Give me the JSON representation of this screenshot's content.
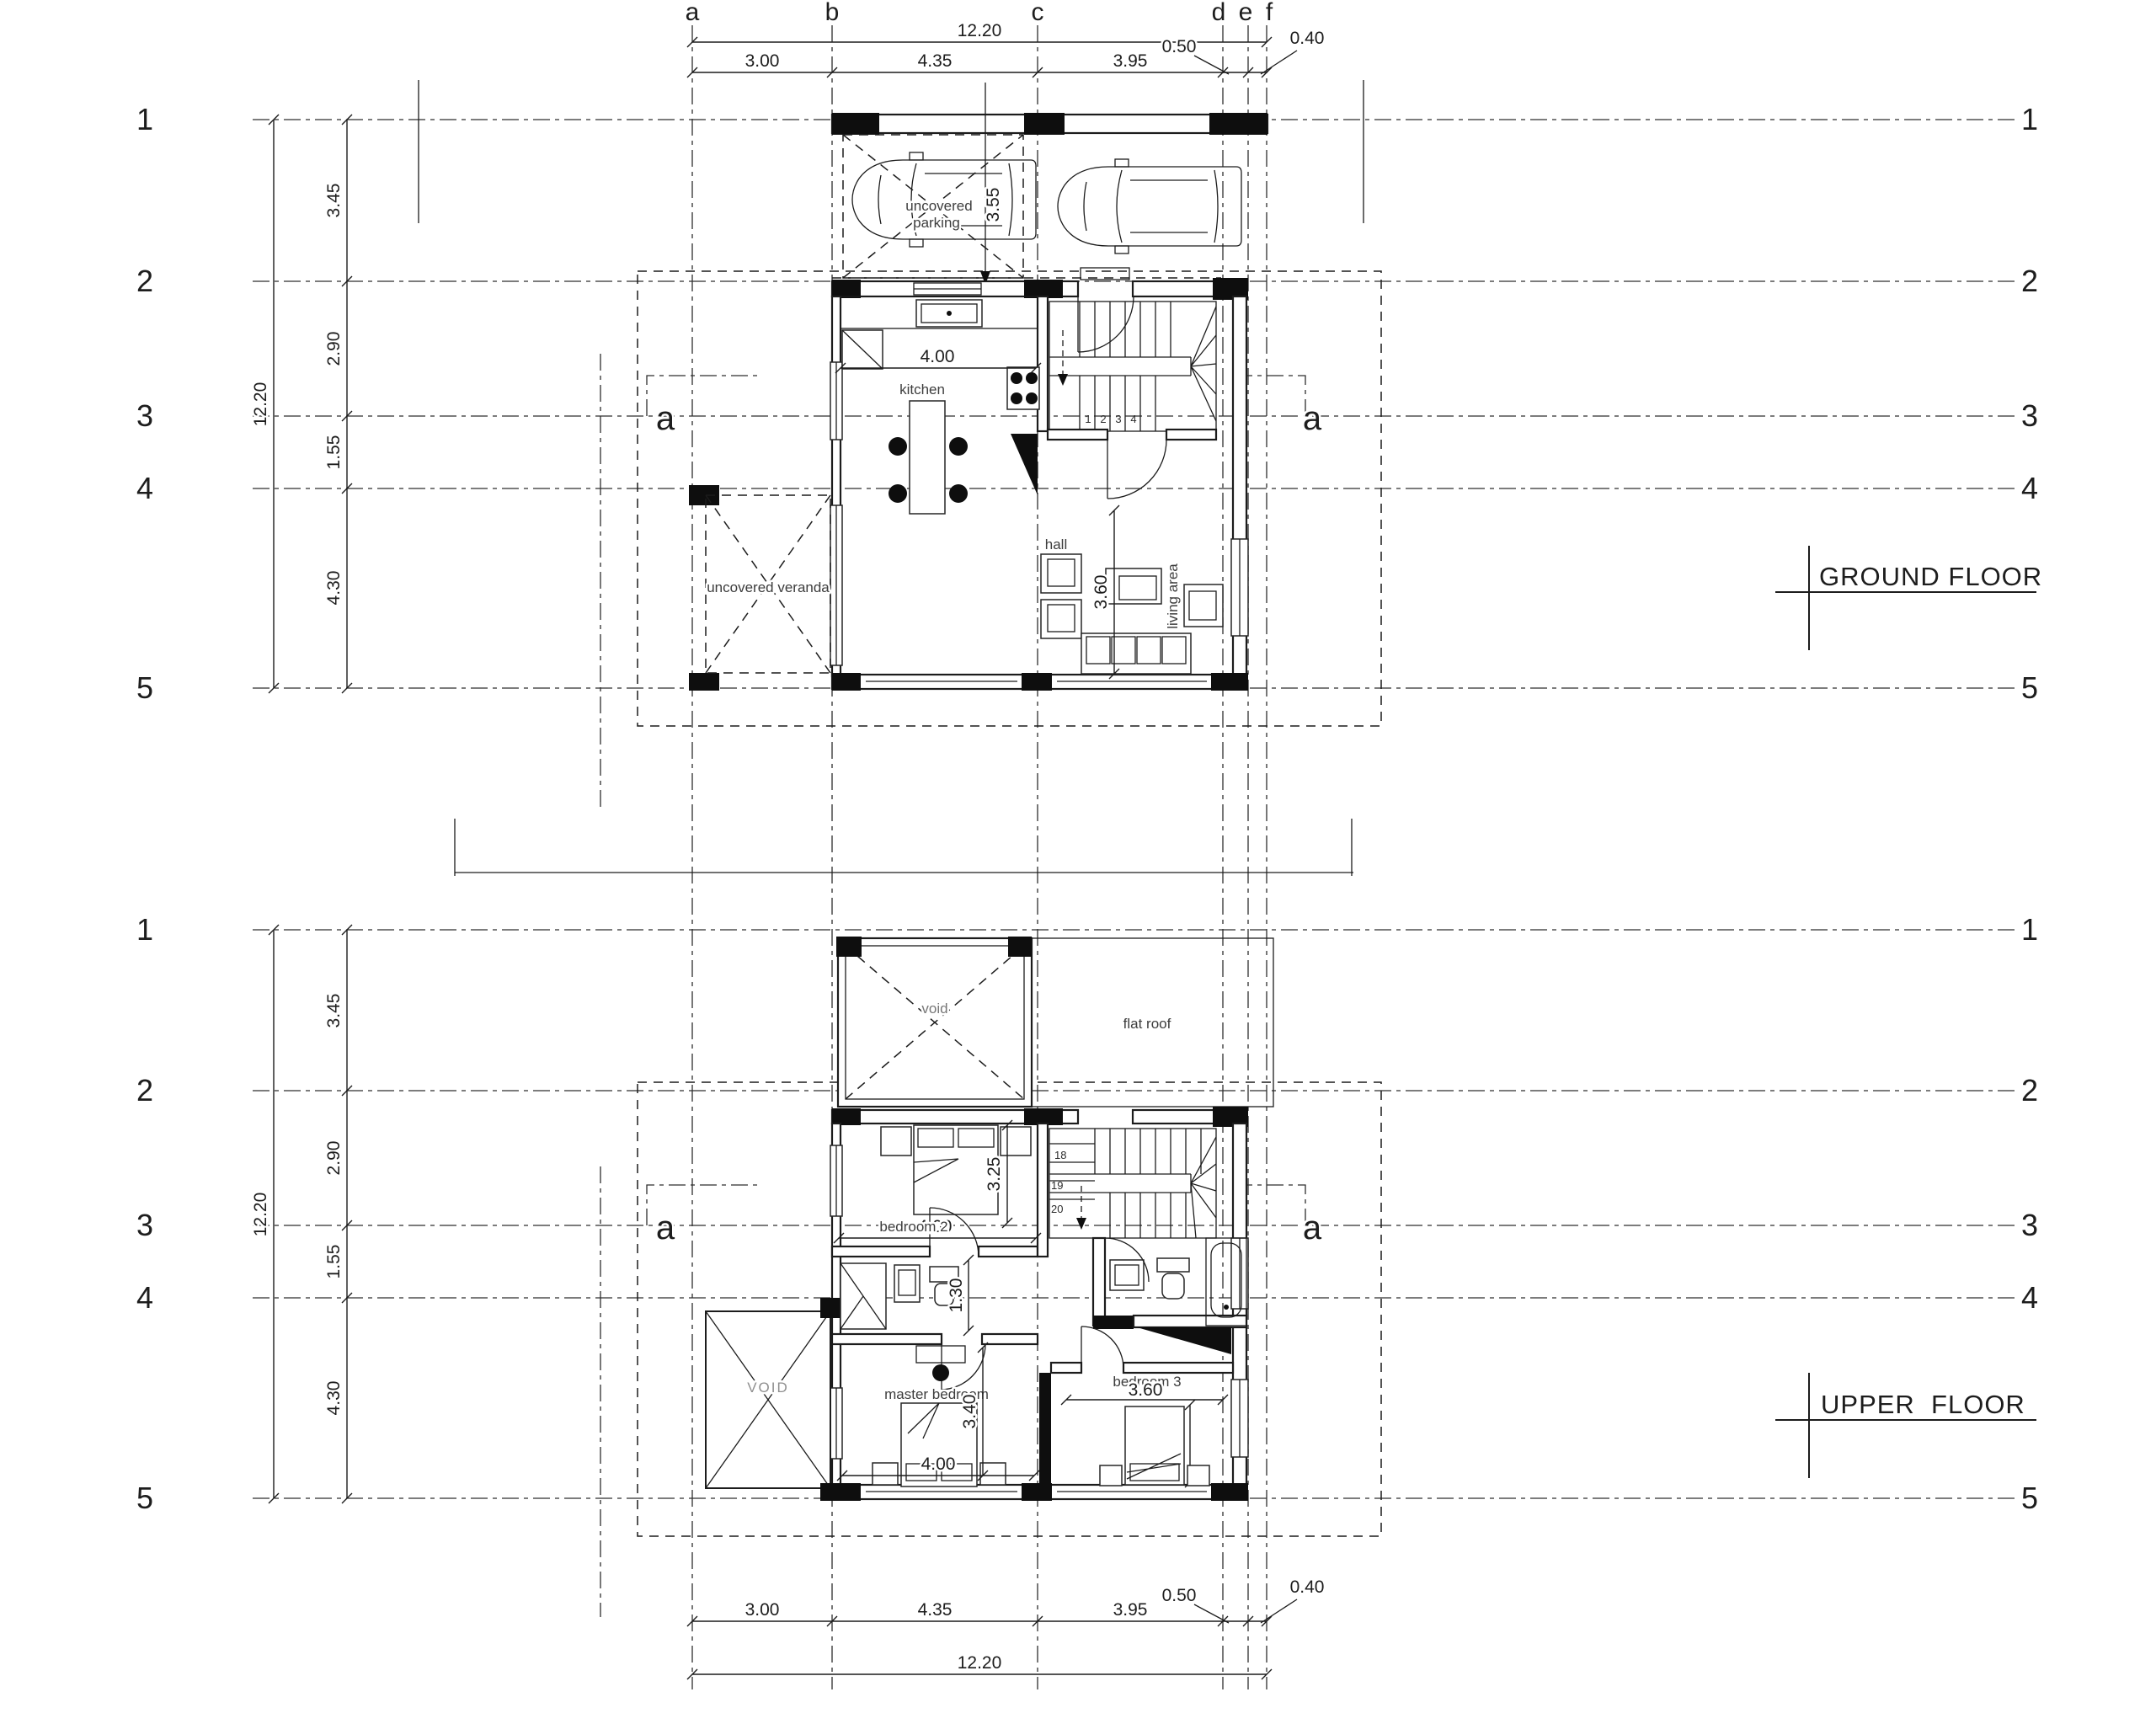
{
  "drawing": {
    "grid": {
      "columns": [
        "a",
        "b",
        "c",
        "d",
        "e",
        "f"
      ],
      "rows": [
        "1",
        "2",
        "3",
        "4",
        "5"
      ],
      "section_mark": "a"
    },
    "dimensions": {
      "overall": "12.20",
      "width_segments": [
        "3.00",
        "4.35",
        "3.95"
      ],
      "width_small": [
        "0.50",
        "0.40"
      ],
      "height_segments": [
        "3.45",
        "2.90",
        "1.55",
        "4.30"
      ]
    },
    "ground_floor": {
      "title": "GROUND FLOOR",
      "rooms": {
        "parking_line1": "uncovered",
        "parking_line2": "parking",
        "kitchen": "kitchen",
        "hall": "hall",
        "living": "living area",
        "veranda": "uncovered veranda"
      },
      "dims": {
        "parking_depth": "3.55",
        "kitchen_width": "4.00",
        "living_depth": "3.60"
      },
      "stair_steps": [
        "1",
        "2",
        "3",
        "4"
      ]
    },
    "upper_floor": {
      "title": "UPPER  FLOOR",
      "rooms": {
        "void": "void",
        "flat_roof": "flat roof",
        "bedroom2": "bedroom 2",
        "master": "master bedroom",
        "bedroom3": "bedroom 3",
        "void_caps": "VOID"
      },
      "dims": {
        "bedroom2_width": "4.00",
        "bedroom2_depth": "3.25",
        "corridor": "1.30",
        "master_width": "4.00",
        "master_depth": "3.40",
        "bedroom3_width": "3.60",
        "bedroom3_depth": "3.80"
      },
      "stair_steps": [
        "18",
        "19",
        "20"
      ]
    }
  }
}
